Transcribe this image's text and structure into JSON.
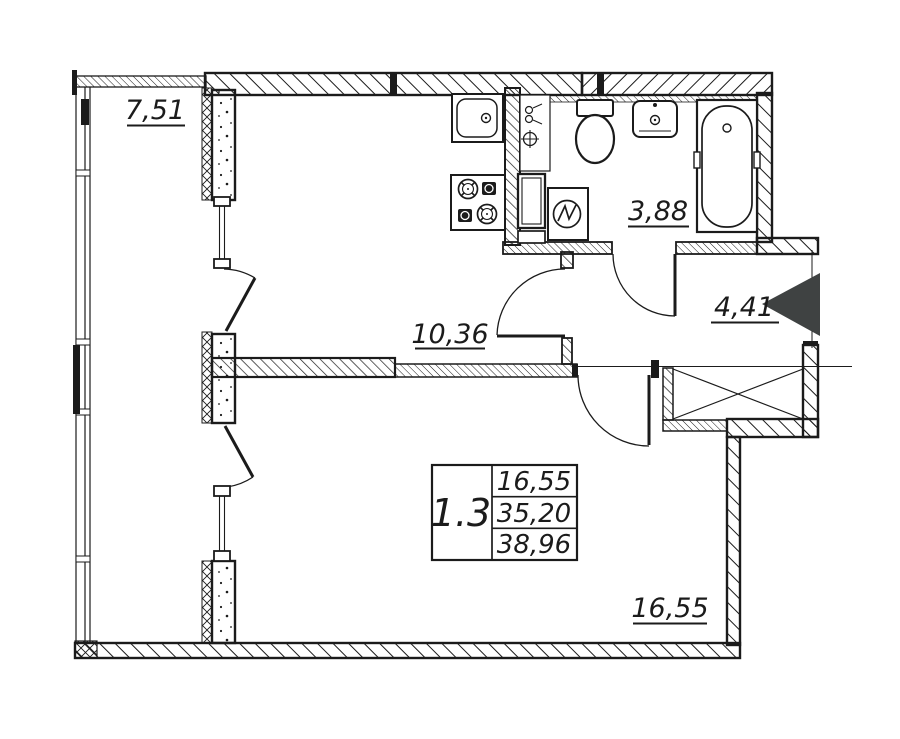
{
  "title": "Apartment floor plan 1.3",
  "colors": {
    "line": "#1b1b1b",
    "entrance_arrow": "#3f4242",
    "background": "#ffffff"
  },
  "labels": {
    "balcony": "7,51",
    "kitchen": "10,36",
    "bathroom": "3,88",
    "hallway": "4,41",
    "living_room": "16,55"
  },
  "stamp": {
    "unit": "1.3",
    "living_area": "16,55",
    "apartment_area": "35,20",
    "total_area": "38,96"
  },
  "icons": [
    "kitchen-sink-icon",
    "gas-stove-icon",
    "plumbing-riser-icon",
    "vent-duct-icon",
    "washing-machine-icon",
    "toilet-icon",
    "wash-basin-icon",
    "bathtub-icon",
    "ventilation-shaft-icon",
    "entrance-arrow-icon",
    "door-swing-icon",
    "balcony-window-icon"
  ]
}
